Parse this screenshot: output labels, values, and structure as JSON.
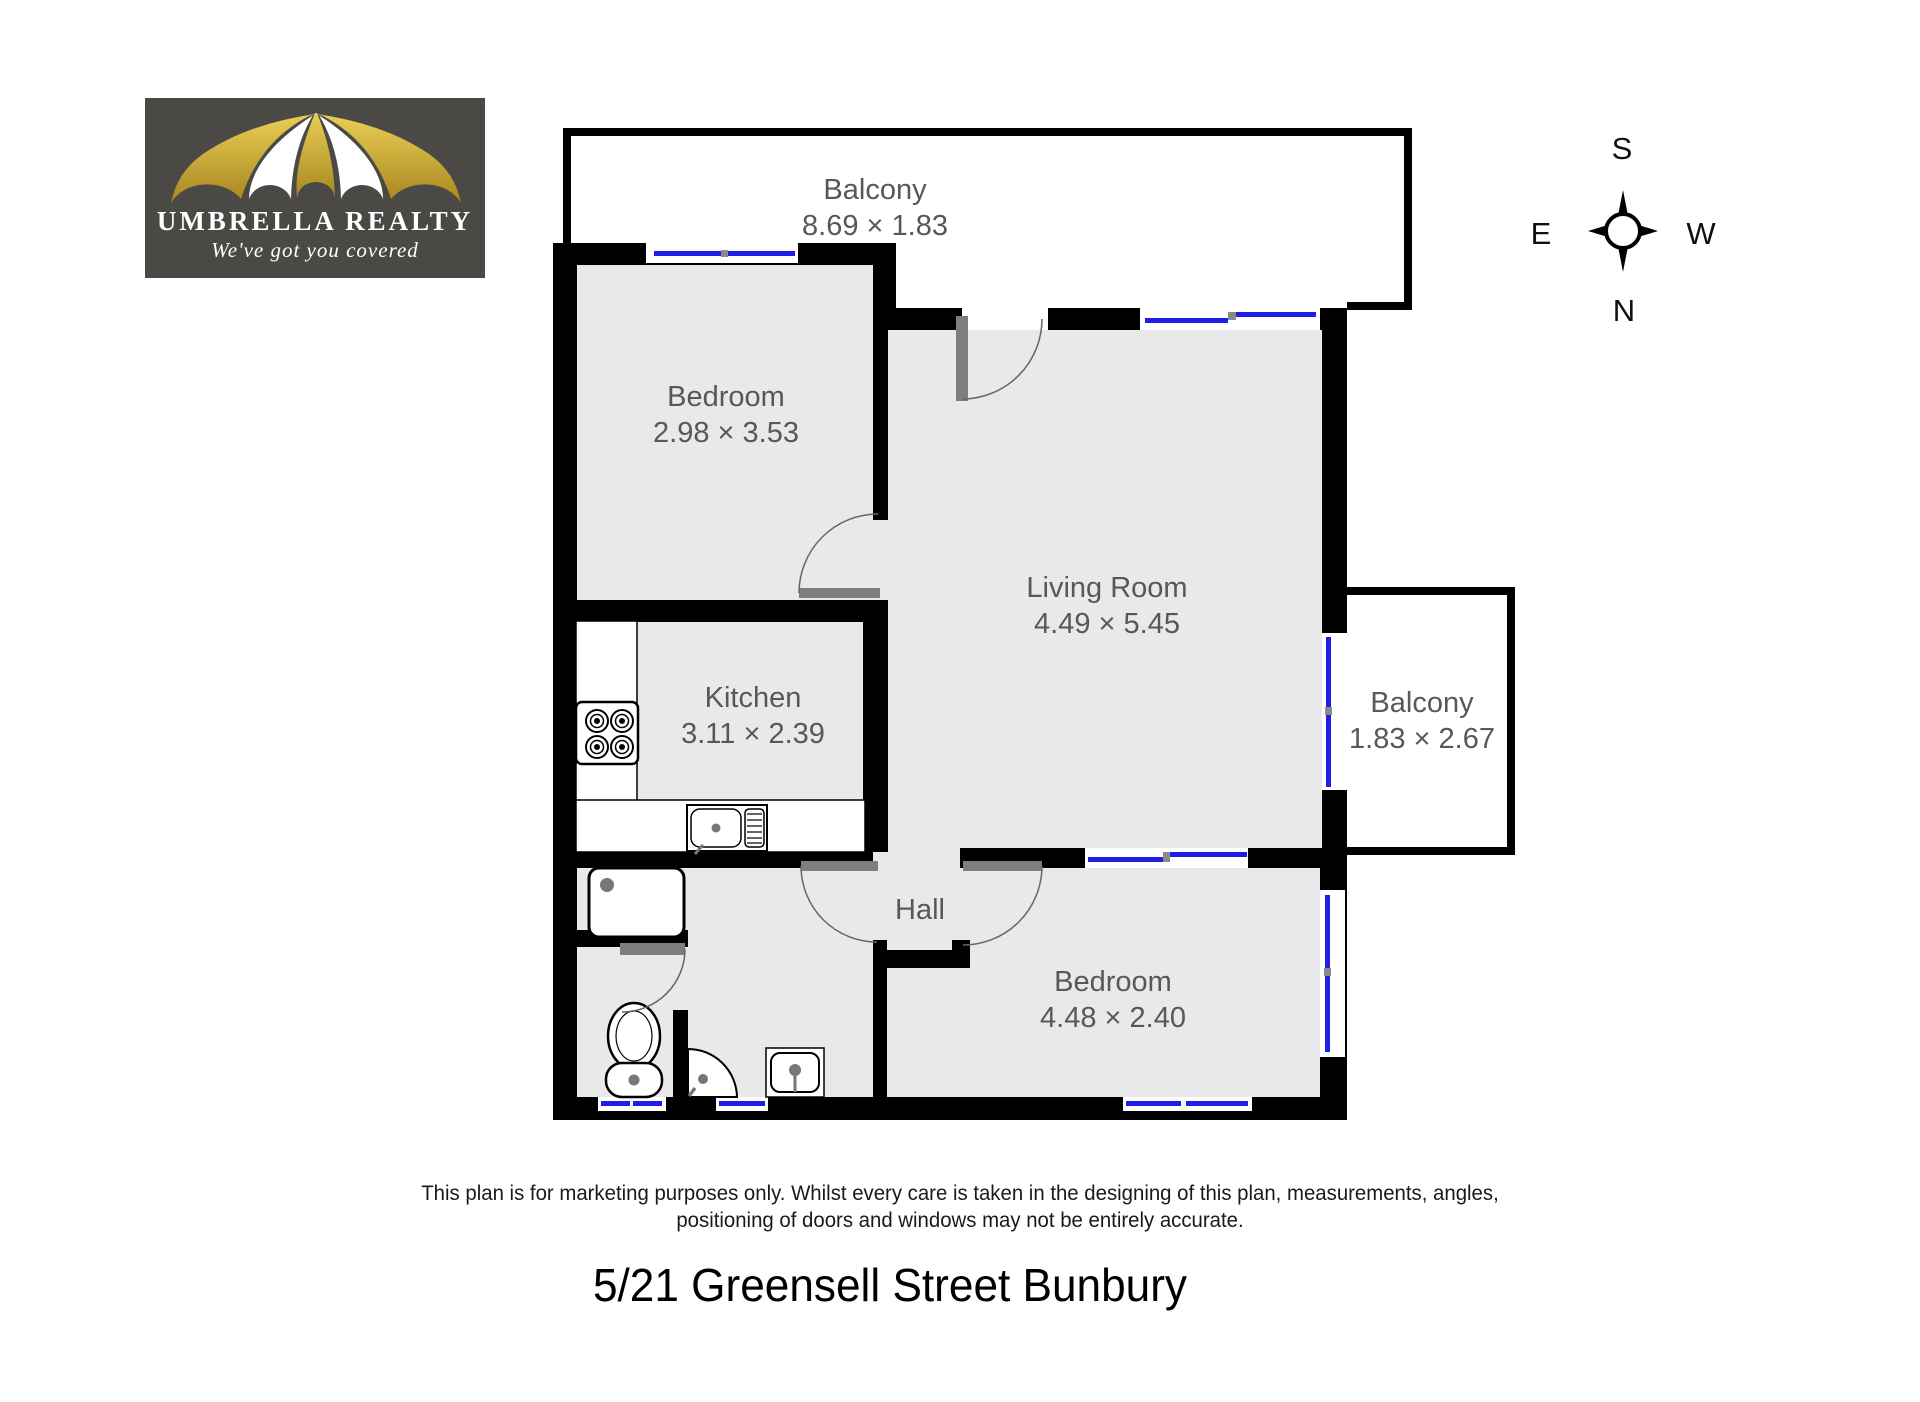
{
  "logo": {
    "name": "UMBRELLA REALTY",
    "tagline": "We've got you covered"
  },
  "compass": {
    "north": "N",
    "south": "S",
    "east": "E",
    "west": "W"
  },
  "floorplan": {
    "rooms": [
      {
        "name": "Balcony",
        "dims": "8.69 × 1.83"
      },
      {
        "name": "Bedroom",
        "dims": "2.98 × 3.53"
      },
      {
        "name": "Living Room",
        "dims": "4.49 × 5.45"
      },
      {
        "name": "Kitchen",
        "dims": "3.11 × 2.39"
      },
      {
        "name": "Balcony",
        "dims": "1.83 × 2.67"
      },
      {
        "name": "Hall",
        "dims": ""
      },
      {
        "name": "Bedroom",
        "dims": "4.48 × 2.40"
      }
    ]
  },
  "footer": {
    "disclaimer_line1": "This plan is for marketing purposes only. Whilst every care is taken in the designing of this plan, measurements, angles,",
    "disclaimer_line2": "positioning of doors and windows may not be entirely accurate.",
    "address": "5/21 Greensell Street Bunbury"
  },
  "colors": {
    "wall": "#000000",
    "window": "#1e1ee8",
    "door_leaf": "#7e7e7e",
    "floor_fill": "#e9e9eb",
    "balcony_fill": "#ffffff",
    "logo_background": "#4a4946",
    "logo_gold": "#c9a636",
    "label_text": "#57585a"
  }
}
